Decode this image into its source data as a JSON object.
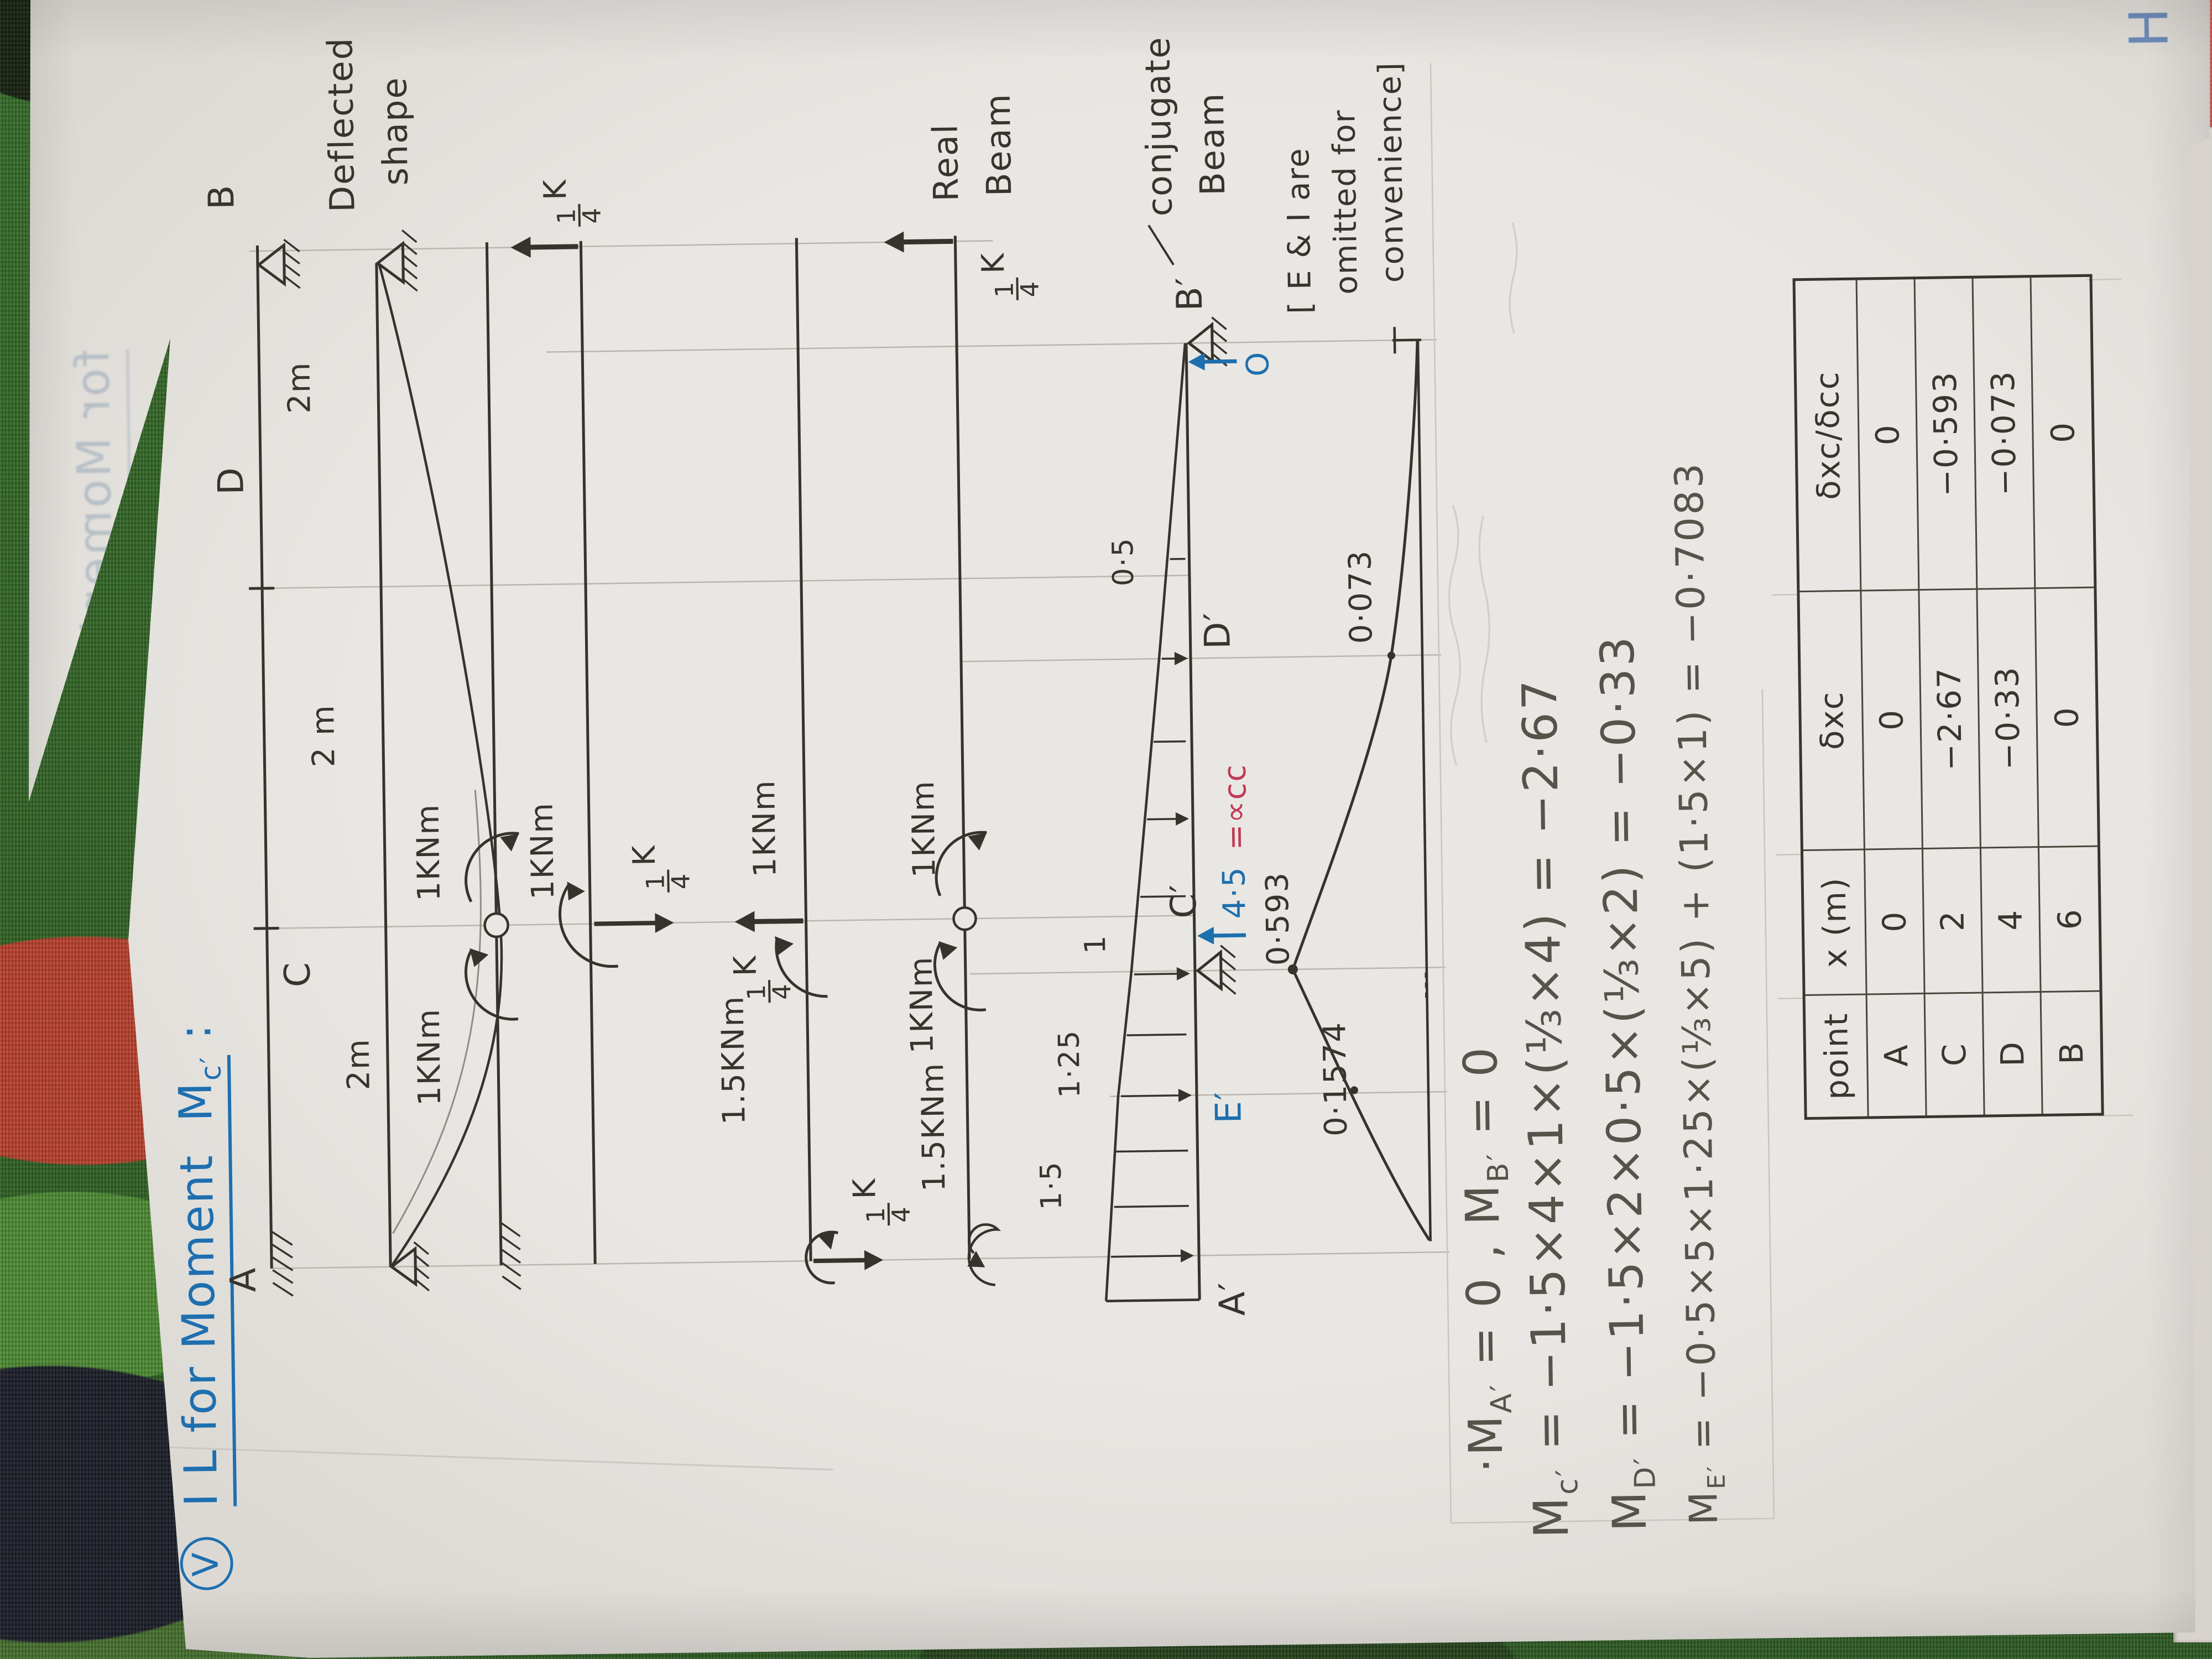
{
  "title": {
    "bullet": "V",
    "main": "I L for Moment",
    "m": "M",
    "sub": "c′",
    "colon": ":"
  },
  "figures": {
    "original": {
      "a": "A",
      "c": "C",
      "d": "D",
      "b": "B",
      "span_ac": "2m",
      "span_cd": "2 m",
      "span_db": "2m"
    },
    "deflected": {
      "line1": "Deflected",
      "line2": "shape"
    },
    "quarter_k": {
      "num": "1",
      "den": "4",
      "unit": "K"
    },
    "hinge_released": {
      "m_left": "1KNm",
      "m_right": "1KNm"
    },
    "segment_cb": {
      "m_c": "1KNm"
    },
    "segment_ac": {
      "m1": "1.5KNm",
      "m2": "1KNm"
    },
    "real_beam": {
      "m_a1": "1.5KNm",
      "m_a2": "1KNm",
      "m_c": "1KNm",
      "cap1": "Real",
      "cap2": "Beam"
    },
    "conjugate": {
      "a": "A′",
      "e": "E′",
      "c": "C′",
      "d": "D′",
      "b": "B′",
      "w_a": "1·5",
      "w_e": "1·25",
      "w_c": "1",
      "w_d": "0·5",
      "r_c_val": "4·5",
      "r_c_eq": "=∝cc",
      "r_b": "O",
      "cap1": "conjugate",
      "cap2": "Beam",
      "note1": "[ E & I are",
      "note2": "omitted for",
      "note3": "convenience]"
    },
    "il": {
      "v_c": "0·593",
      "v_e": "0·1574",
      "v_d": "0·073"
    }
  },
  "formulas": {
    "l1": {
      "p1": "·M",
      "s1": "A′",
      "p2": " = 0  ,  M",
      "s2": "B′",
      "p3": " = 0"
    },
    "l2": {
      "h": "M",
      "s": "c′",
      "rest": " = −1·5×4×1×(⅓×4) = −2·67"
    },
    "l3": {
      "h": "M",
      "s": "D′",
      "rest": " = −1·5×2×0·5×(⅓×2) = −0·33"
    },
    "l4": {
      "h": "M",
      "s": "E′",
      "rest": " = −0·5×5×1·25×(⅓×5) + (1·5×1) = −0·7083"
    }
  },
  "table": {
    "headers": [
      "point",
      "x (m)",
      "δxc",
      "δxc/δcc"
    ],
    "rows": [
      [
        "A",
        "0",
        "0",
        "0"
      ],
      [
        "C",
        "2",
        "−2·67",
        "−0·593"
      ],
      [
        "D",
        "4",
        "−0·33",
        "−0·073"
      ],
      [
        "B",
        "6",
        "0",
        "0"
      ]
    ]
  },
  "ghosts": {
    "bleed_title": "for Moment",
    "corner_mark": "H"
  }
}
